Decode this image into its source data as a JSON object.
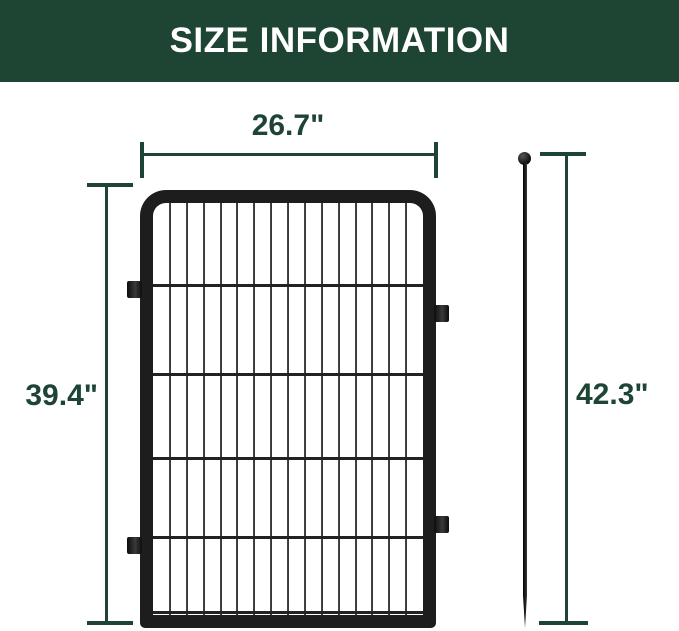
{
  "header": {
    "title": "SIZE INFORMATION"
  },
  "colors": {
    "header_bg": "#1e4434",
    "accent_green": "#1d4434",
    "frame_black": "#1d1d1d",
    "wire_gray": "#333333",
    "background": "#ffffff"
  },
  "diagram": {
    "panel": {
      "width_dim_label": "26.7\"",
      "height_dim_label": "39.4\"",
      "grid": {
        "vertical_wires": 15,
        "horizontal_wire_percents": [
          19.9,
          41.5,
          61.9,
          81.1,
          99.2
        ]
      },
      "connector_tab_count": 4
    },
    "stake": {
      "height_dim_label": "42.3\""
    }
  }
}
